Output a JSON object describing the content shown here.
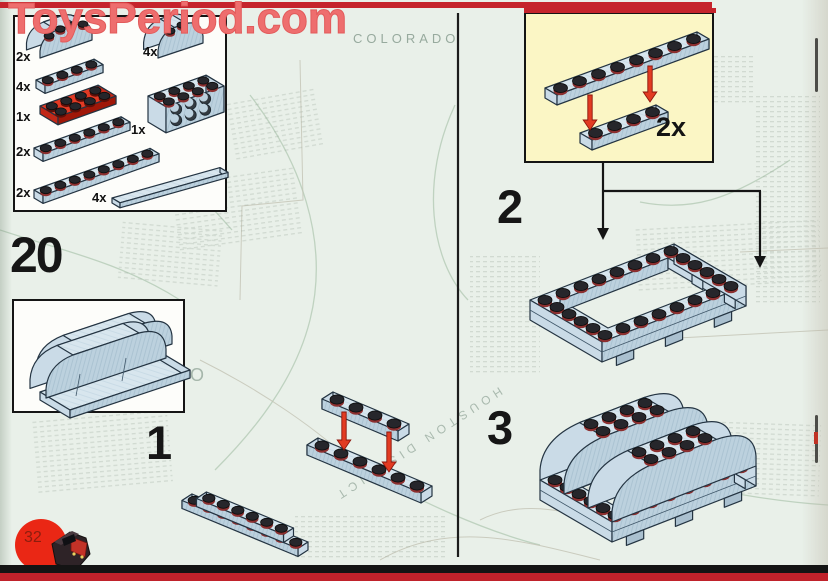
{
  "watermark": {
    "text": "ToysPeriod.com"
  },
  "page": {
    "step_number": "20",
    "page_number": "32"
  },
  "parts_box": {
    "items": [
      {
        "qty": "2x",
        "part": "fender-brick-curved"
      },
      {
        "qty": "4x",
        "part": "curved-brick-small"
      },
      {
        "qty": "4x",
        "part": "plate-1x4"
      },
      {
        "qty": "1x",
        "part": "plate-2x4-red"
      },
      {
        "qty": "1x",
        "part": "brick-2x4-side-studs"
      },
      {
        "qty": "2x",
        "part": "plate-1x6"
      },
      {
        "qty": "2x",
        "part": "plate-1x8"
      },
      {
        "qty": "4x",
        "part": "tile-1x8-smooth"
      }
    ]
  },
  "steps": {
    "step1": {
      "label": "1"
    },
    "step2": {
      "label": "2",
      "inset": {
        "qty": "2x"
      }
    },
    "step3": {
      "label": "3"
    }
  },
  "map": {
    "labels": [
      {
        "text": "COLORADO"
      },
      {
        "text": "ICO"
      },
      {
        "text": "HOUSTON DISTRICT"
      }
    ]
  },
  "colors": {
    "accent_red": "#c5242c",
    "watermark_red": "#ee6e6e",
    "brick_blue": "#d8e6ee",
    "plate_red": "#e23a24",
    "inset_yellow": "#fbf6c5",
    "map_background": "#e9f0e9"
  }
}
